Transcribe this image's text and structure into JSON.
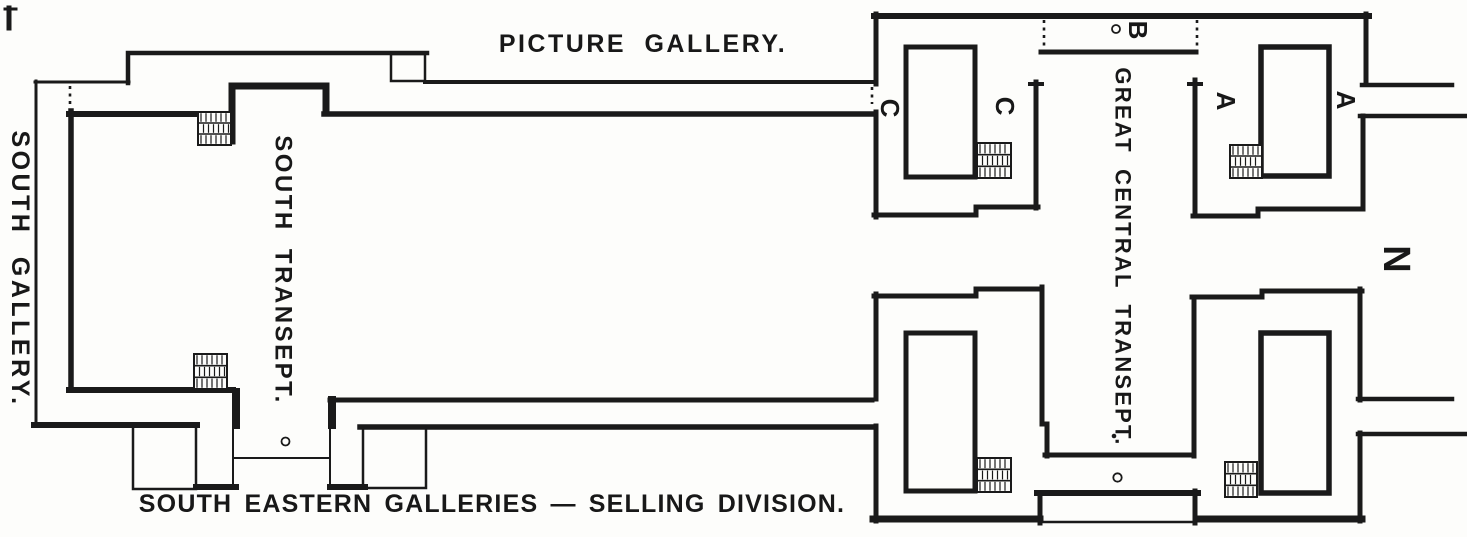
{
  "plan": {
    "labels": {
      "picture_gallery": "PICTURE GALLERY.",
      "south_gallery": "SOUTH GALLERY.",
      "south_transept": "SOUTH TRANSEPT.",
      "great_central_transept": "GREAT CENTRAL TRANSEPT.",
      "south_eastern_galleries": "SOUTH EASTERN GALLERIES — SELLING DIVISION."
    },
    "markers": {
      "stand_c_west": "C",
      "stand_c_inner": "C",
      "stand_b": "B",
      "stand_a_inner": "A",
      "stand_a_east": "A",
      "north_indicator": "N"
    },
    "symbols": {
      "staircase": "hatched-stairs-block",
      "wall_opening": "dashed-wall-gap",
      "column_marker": "small-open-circle"
    },
    "colors": {
      "ink": "#1a1a1a",
      "paper": "#fdfdfb"
    }
  }
}
